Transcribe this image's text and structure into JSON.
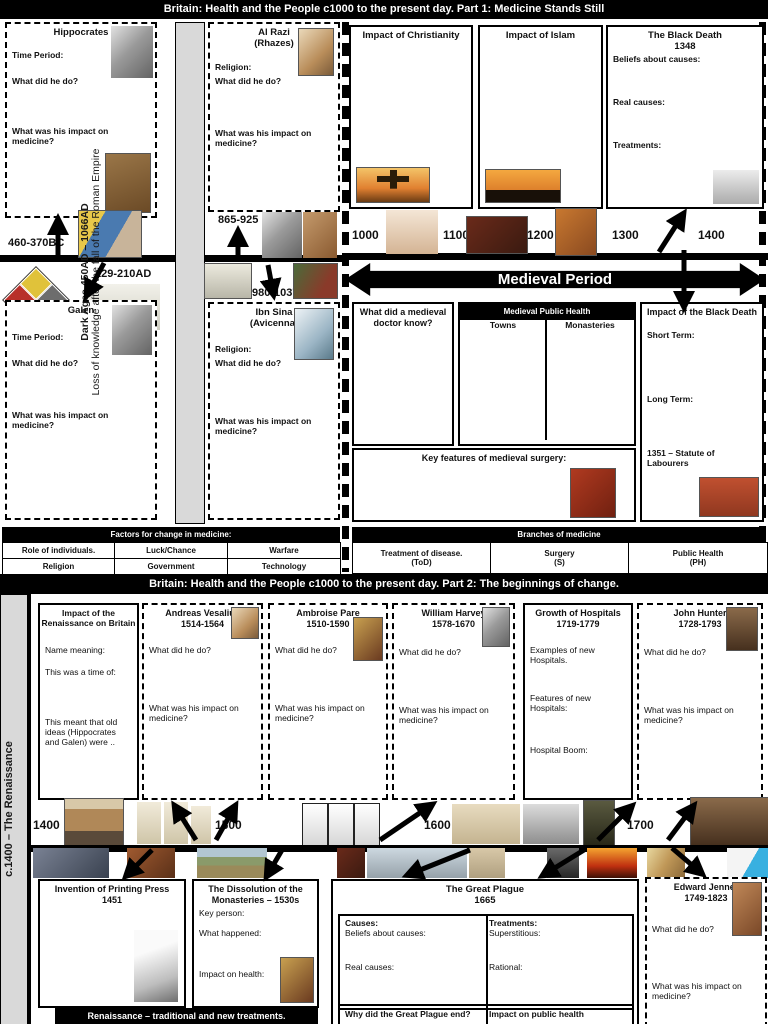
{
  "part1": {
    "title": "Britain: Health and the People c1000 to the present day. Part 1: Medicine Stands Still",
    "sidebar_line1": "Dark Ages 450AD – 1066AD",
    "sidebar_line2": "Loss of knowledge after the fall of the Roman Empire",
    "hippocrates": {
      "name": "Hippocrates",
      "dates": "460-370BC",
      "time_period": "Time Period:",
      "q_do": "What did he do?",
      "q_impact": "What was his impact on medicine?"
    },
    "galen": {
      "name": "Galen",
      "dates": "129-210AD",
      "time_period": "Time Period:",
      "q_do": "What did he do?",
      "q_impact": "What was his impact on medicine?"
    },
    "al_razi": {
      "name": "Al Razi",
      "alias": "(Rhazes)",
      "dates": "865-925",
      "religion": "Religion:",
      "q_do": "What did he do?",
      "q_impact": "What was his impact on medicine?"
    },
    "ibn_sina": {
      "name": "Ibn Sina",
      "alias": "(Avicenna)",
      "dates": "980-1037",
      "religion": "Religion:",
      "q_do": "What did he do?",
      "q_impact": "What was his impact on medicine?"
    },
    "christianity_title": "Impact of Christianity",
    "islam_title": "Impact of Islam",
    "black_death": {
      "title": "The Black Death",
      "year": "1348",
      "f1": "Beliefs about causes:",
      "f2": "Real causes:",
      "f3": "Treatments:"
    },
    "timeline": {
      "t1000": "1000",
      "t1100": "1100",
      "t1200": "1200",
      "t1300": "1300",
      "t1400": "1400"
    },
    "medieval_banner": "Medieval Period",
    "doctor_q": "What did a medieval doctor know?",
    "public_health": {
      "title": "Medieval Public Health",
      "col1": "Towns",
      "col2": "Monasteries"
    },
    "impact_black_death": {
      "title": "Impact of the Black Death",
      "f1": "Short Term:",
      "f2": "Long Term:",
      "f3": "1351 – Statute of Labourers"
    },
    "surgery_title": "Key features of medieval surgery:"
  },
  "factors": {
    "title": "Factors for change in medicine:",
    "c1": "Role of individuals.",
    "c2": "Luck/Chance",
    "c3": "Warfare",
    "c4": "Religion",
    "c5": "Government",
    "c6": "Technology"
  },
  "branches": {
    "title": "Branches of medicine",
    "c1a": "Treatment of disease.",
    "c1b": "(ToD)",
    "c2a": "Surgery",
    "c2b": "(S)",
    "c3a": "Public Health",
    "c3b": "(PH)"
  },
  "part2": {
    "title": "Britain: Health and the People c1000 to the present day. Part 2: The beginnings of change.",
    "sidebar": "c.1400 – The Renaissance",
    "renaissance": {
      "title1": "Impact of the",
      "title2": "Renaissance on Britain",
      "f1": "Name meaning:",
      "f2": "This was a time of:",
      "f3": "This meant that old ideas (Hippocrates and Galen) were .."
    },
    "vesalius": {
      "name": "Andreas Vesalius",
      "dates": "1514-1564",
      "q_do": "What did he do?",
      "q_impact": "What was his impact on medicine?"
    },
    "pare": {
      "name": "Ambroise Pare",
      "dates": "1510-1590",
      "q_do": "What did he do?",
      "q_impact": "What was his impact on medicine?"
    },
    "harvey": {
      "name": "William Harvey",
      "dates": "1578-1670",
      "q_do": "What did he do?",
      "q_impact": "What was his impact on medicine?"
    },
    "hospitals": {
      "title": "Growth of Hospitals",
      "dates": "1719-1779",
      "f1": "Examples of new Hospitals.",
      "f2": "Features of new Hospitals:",
      "f3": "Hospital Boom:"
    },
    "hunter": {
      "name": "John Hunter",
      "dates": "1728-1793",
      "q_do": "What did he do?",
      "q_impact": "What was his impact on medicine?"
    },
    "timeline": {
      "t1400": "1400",
      "t1500": "1500",
      "t1600": "1600",
      "t1700": "1700"
    },
    "printing": {
      "title": "Invention of Printing Press",
      "year": "1451"
    },
    "dissolution": {
      "title1": "The Dissolution of the",
      "title2": "Monasteries – 1530s",
      "f1": "Key person:",
      "f2": "What happened:",
      "f3": "Impact on health:"
    },
    "plague": {
      "title": "The Great Plague",
      "year": "1665",
      "causes": "Causes:",
      "beliefs": "Beliefs about causes:",
      "real": "Real causes:",
      "treatments": "Treatments:",
      "superstitious": "Superstitious:",
      "rational": "Rational:",
      "q_end": "Why did the Great Plague end?",
      "q_ph": "Impact on public health"
    },
    "jenner": {
      "name": "Edward Jenner",
      "dates": "1749-1823",
      "q_do": "What did he do?",
      "q_impact": "What was his impact on medicine?"
    },
    "banner": "Renaissance – traditional and new treatments."
  },
  "colors": {
    "ink": "#000000",
    "paper": "#ffffff",
    "strip": "#d9d9d9"
  }
}
